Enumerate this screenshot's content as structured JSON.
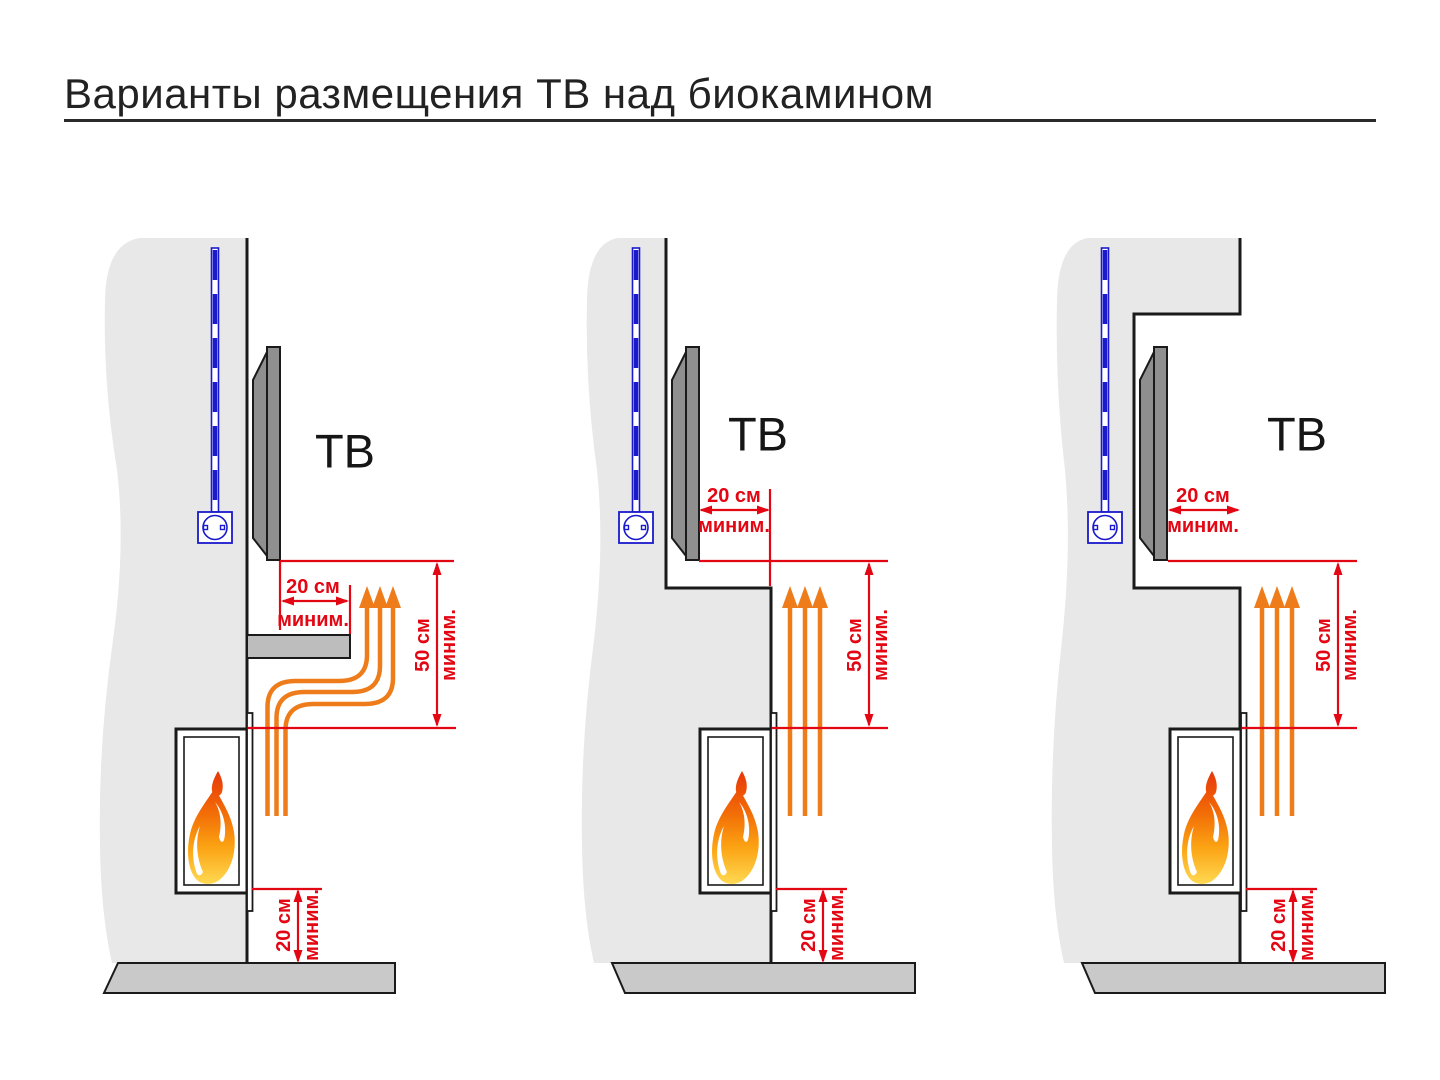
{
  "title": "Варианты размещения ТВ над биокамином",
  "colors": {
    "background": "#ffffff",
    "wall_fill": "#e8e8e8",
    "floor_fill": "#c9c9c9",
    "tv_fill": "#8f8f8f",
    "outline": "#1a1a1a",
    "dimension_red": "#e30613",
    "heat_orange": "#ee7c1b",
    "cable_blue": "#1a1acc",
    "flame_gradient": [
      "#e63408",
      "#f26c07",
      "#fba313",
      "#ffd952"
    ]
  },
  "panels": [
    {
      "id": "left",
      "tv_label": "ТВ",
      "front_dim": {
        "value": "20 см",
        "qualifier": "миним."
      },
      "clearance_dim": {
        "value": "50 см",
        "qualifier": "миним."
      },
      "floor_dim": {
        "value": "20 см",
        "qualifier": "миним."
      }
    },
    {
      "id": "center",
      "tv_label": "ТВ",
      "front_dim": {
        "value": "20 см",
        "qualifier": "миним."
      },
      "clearance_dim": {
        "value": "50 см",
        "qualifier": "миним."
      },
      "floor_dim": {
        "value": "20 см",
        "qualifier": "миним."
      }
    },
    {
      "id": "right",
      "tv_label": "ТВ",
      "front_dim": {
        "value": "20 см",
        "qualifier": "миним."
      },
      "clearance_dim": {
        "value": "50 см",
        "qualifier": "миним."
      },
      "floor_dim": {
        "value": "20 см",
        "qualifier": "миним."
      }
    }
  ]
}
